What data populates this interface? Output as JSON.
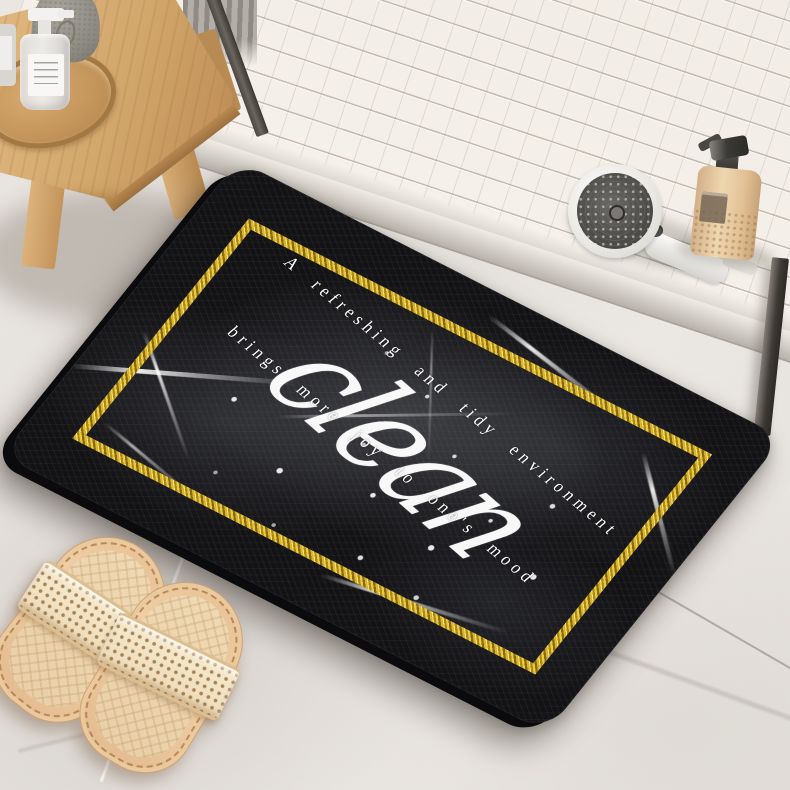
{
  "photo": {
    "subject": "black marble diatomite bath mat with gold glitter border, in a bathroom with wooden stool, shower head, lotion bottle and tan slippers",
    "mat": {
      "script_word": "clean",
      "caption_line1": "A refreshing and tidy environment",
      "caption_line2": "brings more joy to one's mood"
    },
    "palette": {
      "mat_marble": "#141418",
      "gold_border": "#d9b52b",
      "caption_text": "#ffffff",
      "floor_marble": "#e7e3df",
      "shower_tile": "#f2eee8",
      "stool_wood": "#d8ae77",
      "slipper_tan": "#ecd0a6",
      "frame_metal": "#4a4641"
    }
  }
}
